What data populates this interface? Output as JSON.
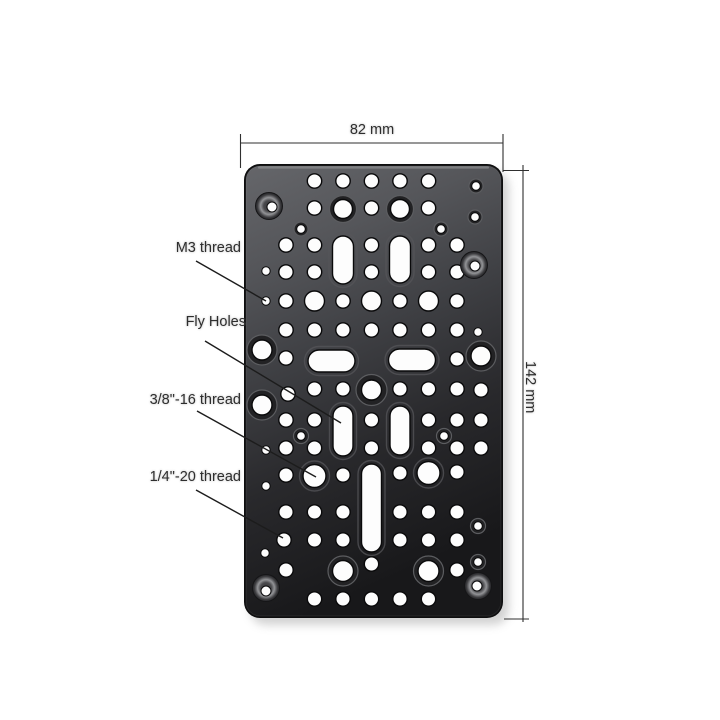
{
  "dimensions": {
    "width_label": "82 mm",
    "height_label": "142 mm"
  },
  "annotations": [
    {
      "label": "M3 thread",
      "leader": [
        196,
        261,
        266,
        301
      ]
    },
    {
      "label": "Fly Holes",
      "leader": [
        205,
        341,
        341,
        423
      ]
    },
    {
      "label": "3/8\"-16 thread",
      "leader": [
        197,
        411,
        316,
        477
      ]
    },
    {
      "label": "1/4\"-20 thread",
      "leader": [
        196,
        490,
        283,
        538
      ]
    }
  ],
  "colors": {
    "background": "#ffffff",
    "plate_top": "#65666a",
    "plate_bottom": "#18181a",
    "hole": "#fdfdfd",
    "annotation_line": "#1c1c1c",
    "label_text": "#2e2e2e"
  },
  "plate": {
    "x": 244,
    "y": 164,
    "w": 259,
    "h": 454,
    "corner_radius": 16,
    "dim_lines": {
      "top": [
        240.5,
        143,
        503,
        143
      ],
      "top_ticks": [
        [
          240.5,
          134,
          240.5,
          168
        ],
        [
          503,
          134,
          503,
          172
        ]
      ],
      "right": [
        523,
        165,
        523,
        622
      ],
      "right_ticks": [
        [
          503,
          170.5,
          529,
          170.5
        ],
        [
          504,
          619,
          529,
          619
        ]
      ]
    },
    "holes": {
      "small_r": 4.2,
      "small": [
        [
          266,
          271
        ],
        [
          266,
          301
        ],
        [
          266,
          450
        ],
        [
          266,
          486
        ],
        [
          265,
          553
        ],
        [
          478,
          332
        ]
      ],
      "med_r": 7.2,
      "med": [
        [
          314.5,
          181
        ],
        [
          343,
          181
        ],
        [
          371.5,
          181
        ],
        [
          400,
          181
        ],
        [
          428.5,
          181
        ],
        [
          314.5,
          208
        ],
        [
          371.5,
          208
        ],
        [
          428.5,
          208
        ],
        [
          286,
          245
        ],
        [
          314.5,
          245
        ],
        [
          371.5,
          245
        ],
        [
          428.5,
          245
        ],
        [
          457,
          245
        ],
        [
          286,
          272
        ],
        [
          314.5,
          272
        ],
        [
          371.5,
          272
        ],
        [
          428.5,
          272
        ],
        [
          457,
          272
        ],
        [
          286,
          301
        ],
        [
          343,
          301
        ],
        [
          400,
          301
        ],
        [
          457,
          301
        ],
        [
          286,
          330
        ],
        [
          314.5,
          330
        ],
        [
          343,
          330
        ],
        [
          371.5,
          330
        ],
        [
          400,
          330
        ],
        [
          428.5,
          330
        ],
        [
          457,
          330
        ],
        [
          286,
          358
        ],
        [
          457,
          359
        ],
        [
          288,
          394
        ],
        [
          314.5,
          389
        ],
        [
          343,
          389
        ],
        [
          400,
          389
        ],
        [
          428.5,
          389
        ],
        [
          457,
          389
        ],
        [
          481,
          390
        ],
        [
          286,
          420
        ],
        [
          314.5,
          420
        ],
        [
          371.5,
          420
        ],
        [
          428.5,
          420
        ],
        [
          457,
          420
        ],
        [
          481,
          420
        ],
        [
          286,
          448
        ],
        [
          314.5,
          448
        ],
        [
          371.5,
          448
        ],
        [
          428.5,
          448
        ],
        [
          457,
          448
        ],
        [
          481,
          448
        ],
        [
          286,
          475
        ],
        [
          343,
          475
        ],
        [
          400,
          473
        ],
        [
          457,
          472
        ],
        [
          286,
          512
        ],
        [
          314.5,
          512
        ],
        [
          343,
          512
        ],
        [
          400,
          512
        ],
        [
          428.5,
          512
        ],
        [
          457,
          512
        ],
        [
          284,
          540
        ],
        [
          314.5,
          540
        ],
        [
          343,
          540
        ],
        [
          400,
          540
        ],
        [
          428.5,
          540
        ],
        [
          457,
          540
        ],
        [
          286,
          570
        ],
        [
          371.5,
          564
        ],
        [
          457,
          570
        ],
        [
          314.5,
          599
        ],
        [
          343,
          599
        ],
        [
          371.5,
          599
        ],
        [
          400,
          599
        ],
        [
          428.5,
          599
        ]
      ],
      "large_r": 10,
      "large": [
        [
          314.5,
          301
        ],
        [
          371.5,
          301
        ],
        [
          428.5,
          301
        ]
      ],
      "xl_r": 11.5,
      "xl": [
        [
          314.5,
          476
        ],
        [
          428.5,
          473
        ]
      ],
      "ringed": [
        [
          343,
          209,
          13.5,
          9.5
        ],
        [
          400,
          209,
          13.5,
          9.5
        ],
        [
          371.5,
          390,
          15.5,
          10
        ],
        [
          343,
          571,
          15,
          10.5
        ],
        [
          428.5,
          571,
          15,
          10.5
        ],
        [
          262,
          350,
          15,
          10
        ],
        [
          262,
          405,
          15,
          10
        ],
        [
          481,
          356,
          15,
          10
        ]
      ],
      "ringed_small": [
        [
          301,
          229,
          7,
          4.3
        ],
        [
          441,
          229,
          7,
          4.3
        ],
        [
          476,
          186,
          7,
          4.3
        ],
        [
          475,
          217,
          7,
          4.3
        ],
        [
          301,
          436,
          7.5,
          4.3
        ],
        [
          444,
          436,
          7.5,
          4.3
        ],
        [
          478,
          526,
          7.5,
          4.3
        ],
        [
          478,
          562,
          7.5,
          4.3
        ]
      ],
      "corner_screws": [
        [
          269,
          206,
          3,
          1
        ],
        [
          474,
          265,
          1,
          1
        ],
        [
          266,
          588,
          0,
          3
        ],
        [
          478,
          586,
          -1,
          0
        ]
      ],
      "slots_v": [
        [
          343,
          236,
          284,
          21
        ],
        [
          400,
          236,
          283,
          21
        ],
        [
          343,
          406,
          456,
          20
        ],
        [
          400,
          406,
          455,
          20
        ],
        [
          371.5,
          464,
          552,
          20
        ]
      ],
      "slots_h": [
        [
          331.5,
          361,
          47,
          22
        ],
        [
          412,
          360,
          47,
          22
        ]
      ]
    }
  }
}
